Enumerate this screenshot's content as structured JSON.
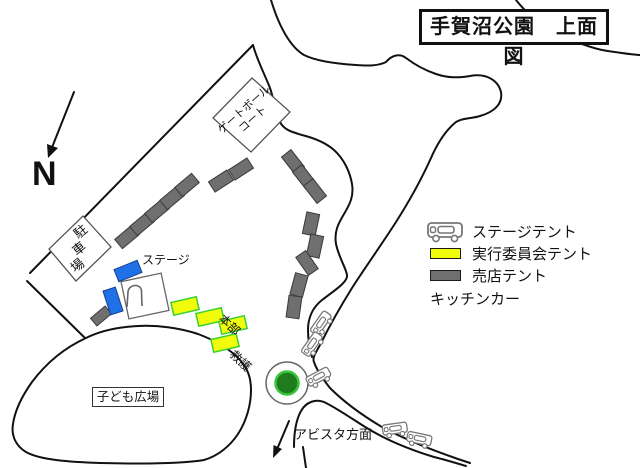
{
  "title": "手賀沼公園　上面図",
  "north_label": "N",
  "legend": {
    "items": [
      {
        "label": "ステージテント",
        "color": "#2071e8",
        "icon": "blue-swatch"
      },
      {
        "label": "実行委員会テント",
        "color": "#f0fc0c",
        "icon": "yellow-swatch"
      },
      {
        "label": "売店テント",
        "color": "#6f6f6f",
        "icon": "gray-swatch"
      },
      {
        "label": "キッチンカー",
        "icon": "kitchen-car-icon"
      }
    ]
  },
  "map_labels": {
    "gateball_line1": "ゲートボール",
    "gateball_line2": "コート",
    "parking": "駐車場",
    "stage": "ステージ",
    "headquarters": "本部",
    "first_aid": "救護",
    "children_plaza": "子ども広場",
    "avista_direction": "アビスタ方面"
  },
  "colors": {
    "stage_tent": "#2071e8",
    "committee_tent": "#f0fc0c",
    "committee_tent_border": "#3ad12f",
    "shop_tent": "#6f6f6f",
    "roundabout_green": "#1e7c1e",
    "line": "#111111"
  }
}
